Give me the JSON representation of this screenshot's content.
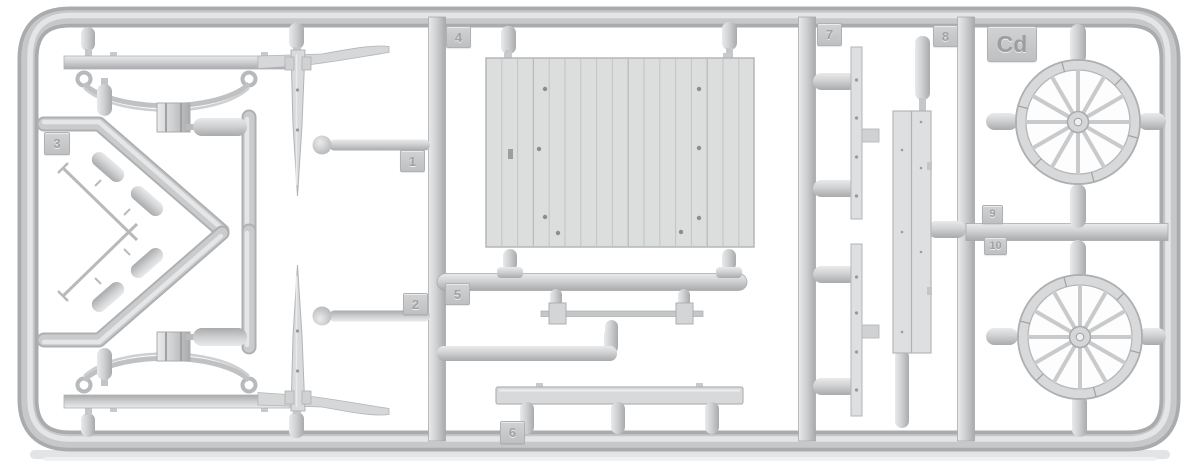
{
  "sprue": {
    "code": "Cd",
    "tags": {
      "t1": "1",
      "t2": "2",
      "t3": "3",
      "t4": "4",
      "t5": "5",
      "t6": "6",
      "t7": "7",
      "t8": "8",
      "t9": "9",
      "t10": "10"
    },
    "colors": {
      "plastic": "#cdcfd1",
      "plastic_highlight": "#e8eaeb",
      "plastic_shadow": "#a8aaac",
      "flat_part": "#dcdedd",
      "background": "#ffffff"
    }
  }
}
